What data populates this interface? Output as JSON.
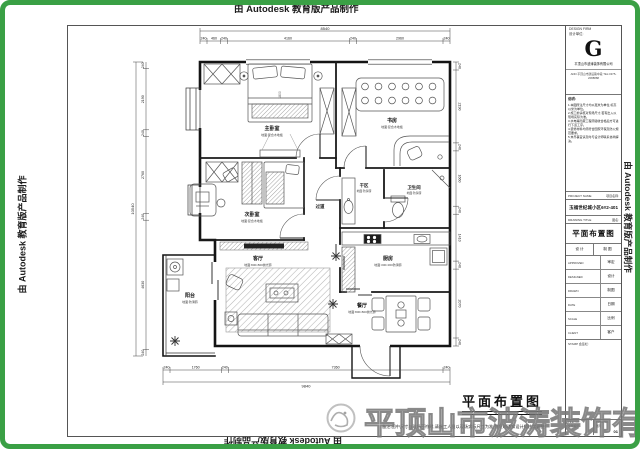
{
  "watermarks": {
    "autodesk": "由 Autodesk 教育版产品制作",
    "company": "平顶山市波涛装饰有限公司"
  },
  "plan": {
    "title": "平面布置图",
    "note": "备注:图中尺寸与现场不符时,请施工人员以现场实际尺寸为准,并及时通知设计师核实调整!",
    "bed_label": "1800",
    "rooms": [
      {
        "name": "主卧室",
        "sub": "地面:复合木地板"
      },
      {
        "name": "书房",
        "sub": "地面:复合木地板"
      },
      {
        "name": "次卧室",
        "sub": "地面:复合木地板"
      },
      {
        "name": "过道",
        "sub": ""
      },
      {
        "name": "干区",
        "sub": "地面:防滑砖"
      },
      {
        "name": "卫生间",
        "sub": "地面:防滑砖"
      },
      {
        "name": "厨房",
        "sub": "地面:300×300防滑砖"
      },
      {
        "name": "客厅",
        "sub": "地面:800×800抛光砖"
      },
      {
        "name": "餐厅",
        "sub": "地面:800×800抛光砖"
      },
      {
        "name": "阳台",
        "sub": "地面:防滑砖"
      }
    ],
    "dims": {
      "top": {
        "total": "8540",
        "segments": [
          "240",
          "460",
          "240",
          "4160",
          "240",
          "2960",
          "240"
        ]
      },
      "bottom": {
        "total": "9840",
        "segments": [
          "240",
          "1760",
          "240",
          "7360",
          "240"
        ]
      },
      "left": {
        "total": "10540",
        "segments": [
          "240",
          "2190",
          "240",
          "2760",
          "240",
          "4630",
          "240"
        ]
      },
      "right": {
        "segments": [
          "240",
          "2190",
          "240",
          "1660",
          "240",
          "1410",
          "240",
          "2070",
          "240"
        ]
      }
    }
  },
  "title_block": {
    "design_firm_en": "DESIGN FIRM",
    "design_firm_cn": "设计单位:",
    "logo": "G",
    "company": "平顶山市波涛装饰有限公司",
    "contact": "ADD:平顶山市建设路中段  TEL:0375-2088888",
    "notes_title": "说明:",
    "notes": [
      "1.本图所注尺寸均以毫米为单位,标高以米为单位。",
      "2.施工前请核对现场尺寸,若有出入以现场实际为准。",
      "3.水电等隐蔽工程须验收合格后方可进行下道工序。",
      "4.装修材料均须符合国家环保及防火规范要求。",
      "5.未尽事宜请及时与设计师联系协商解决。"
    ],
    "project_en": "PROJECT NAME",
    "project_cn": "项目名称:",
    "project_value": "玉福世纪城小区6#2-401",
    "drawing_en": "DRAWING TITLE",
    "drawing_cn": "图名:",
    "drawing_value": "平面布置图",
    "sig_cells": [
      "设 计",
      "制 图"
    ],
    "rows": [
      {
        "en": "APPROVED",
        "cn": "审定"
      },
      {
        "en": "DESIGNED",
        "cn": "设计"
      },
      {
        "en": "DRAWN",
        "cn": "制图"
      },
      {
        "en": "DATE",
        "cn": "日期"
      },
      {
        "en": "SCALE",
        "cn": "比例"
      },
      {
        "en": "CLIENT",
        "cn": "客户"
      }
    ],
    "stamp_en": "STAMP",
    "stamp_cn": "会签栏:",
    "file_en": "FILE NO.",
    "file_cn": "文件编号",
    "dwg_en": "DWG NO.",
    "dwg_cn": "图号",
    "sheet": "01"
  }
}
